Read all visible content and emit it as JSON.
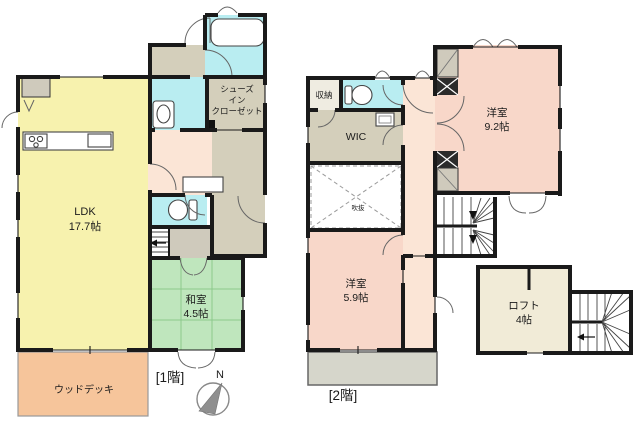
{
  "document_type": "floor-plan",
  "floor1": {
    "label": "[1階]",
    "rooms": {
      "ldk": {
        "name": "LDK",
        "size": "17.7帖"
      },
      "washitsu": {
        "name": "和室",
        "size": "4.5帖"
      },
      "shoes_in_closet": {
        "line1": "シューズ",
        "line2": "イン",
        "line3": "クローゼット"
      },
      "wood_deck": {
        "name": "ウッドデッキ"
      }
    }
  },
  "floor2": {
    "label": "[2階]",
    "rooms": {
      "storage": {
        "name": "収納"
      },
      "wic": {
        "name": "WIC"
      },
      "void": {
        "name": "吹抜"
      },
      "western_room_large": {
        "name": "洋室",
        "size": "9.2帖"
      },
      "western_room_small": {
        "name": "洋室",
        "size": "5.9帖"
      },
      "loft": {
        "name": "ロフト",
        "size": "4帖"
      }
    }
  },
  "compass": {
    "label": "N"
  },
  "colors": {
    "wall": "#1a1a1a",
    "ldk_yellow": "#f7f2ae",
    "tatami_green": "#bfe6bd",
    "wet_area_cyan": "#b9edf1",
    "closet_tan": "#d4cfbb",
    "hall_peach": "#fbe5d6",
    "western_room_pink": "#f8d7c9",
    "wood_deck_salmon": "#f6c59b",
    "loft_cream": "#f1ebd7",
    "balcony_gray": "#d6d6cb"
  }
}
